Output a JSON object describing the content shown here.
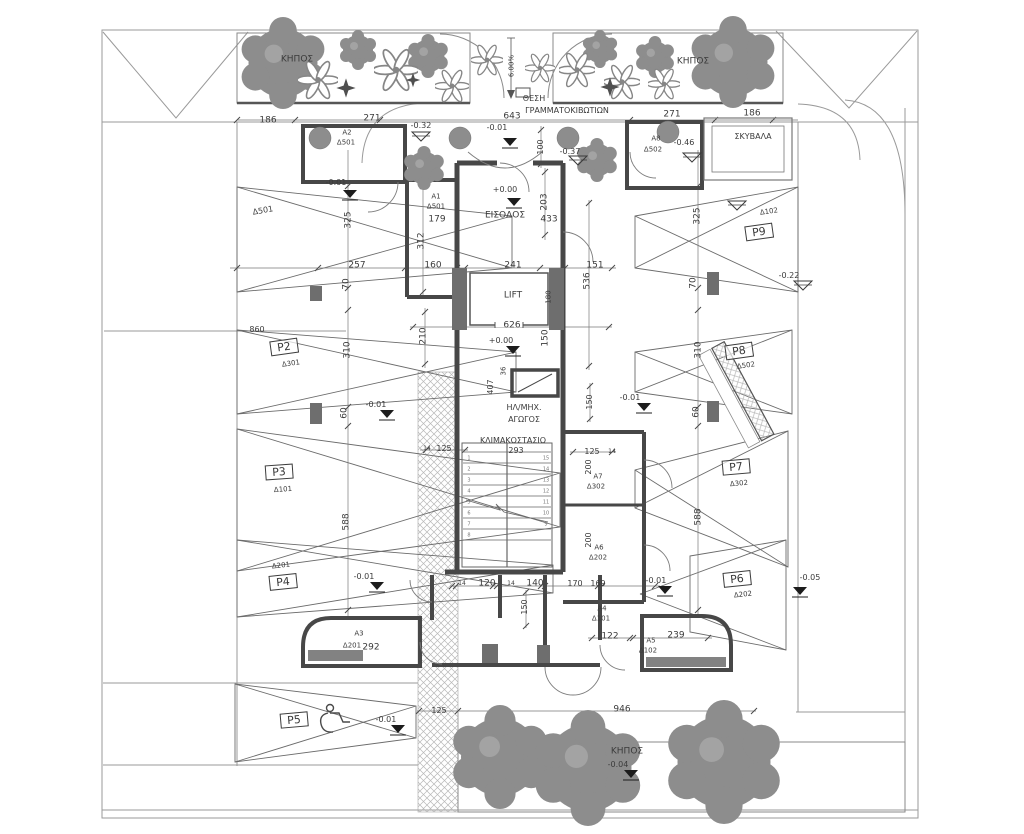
{
  "plan": {
    "building_core": {
      "entrance": "ΕΙΣΟΔΟΣ",
      "entrance_level": "+0.00",
      "lift": "LIFT",
      "staircase": "ΚΛΙΜΑΚΟΣΤΑΣΙΟ",
      "duct": "ΗΛ/ΜΗΧ. ΑΓΩΓΟΣ"
    },
    "storerooms": [
      {
        "id": "Α1",
        "unit": "Δ501"
      },
      {
        "id": "Α2",
        "unit": "Δ501"
      },
      {
        "id": "Α3",
        "unit": "Δ201",
        "width": "292"
      },
      {
        "id": "Α4",
        "unit": "Δ101"
      },
      {
        "id": "Α5",
        "unit": "Δ102",
        "width": "239"
      },
      {
        "id": "Α6",
        "unit": "Δ202",
        "width": "200"
      },
      {
        "id": "Α7",
        "unit": "Δ302",
        "width": "200"
      },
      {
        "id": "Α8",
        "unit": "Δ502"
      }
    ],
    "parking_spaces": [
      {
        "id": "Δ501"
      },
      {
        "id": "P2",
        "unit": "Δ301"
      },
      {
        "id": "P3",
        "unit": "Δ101"
      },
      {
        "id": "P4",
        "unit": "Δ201"
      },
      {
        "id": "P5",
        "accessible": true
      },
      {
        "id": "P6",
        "unit": "Δ202"
      },
      {
        "id": "P7",
        "unit": "Δ302"
      },
      {
        "id": "P8",
        "unit": "Δ502"
      },
      {
        "id": "P9",
        "unit": "Δ102"
      }
    ],
    "gardens": [
      "ΚΗΠΟΣ",
      "ΚΗΠΟΣ",
      "ΚΗΠΟΣ"
    ],
    "refuse_room": "ΣΚΥΒΑΛΑ",
    "mailboxes": "ΘΕΣΗ ΓΡΑΜΜΑΤΟΚΙΒΩΤΙΩΝ",
    "ramp_slope": "6.00%",
    "levels_shown": [
      "+0.00",
      "-0.01",
      "-0.04",
      "-0.05",
      "-0.22",
      "-0.32",
      "-0.37",
      "-0.46"
    ]
  },
  "colors": {
    "paper": "#ffffff",
    "line": "#4a4a4a",
    "wall": "#474747",
    "foliage": "#8d8d8d",
    "hatch": "#b8b8b8"
  },
  "labels": [
    {
      "n": "garden-top-left-label",
      "t": "ΚΗΠΟΣ",
      "x": 297,
      "y": 60,
      "s": 9
    },
    {
      "n": "garden-top-right-label",
      "t": "ΚΗΠΟΣ",
      "x": 693,
      "y": 62,
      "s": 9
    },
    {
      "n": "slope-label",
      "t": "6.00%",
      "x": 512,
      "y": 66,
      "r": -90,
      "s": 7
    },
    {
      "n": "mailbox-label-1",
      "t": "ΘΕΣΗ",
      "x": 534,
      "y": 99,
      "s": 8
    },
    {
      "n": "mailbox-label-2",
      "t": "ΓΡΑΜΜΑΤΟΚΙΒΩΤΙΩΝ",
      "x": 567,
      "y": 111,
      "s": 8
    },
    {
      "n": "dim-643",
      "t": "643",
      "x": 512,
      "y": 117,
      "s": 9
    },
    {
      "n": "dim-186-left",
      "t": "186",
      "x": 268,
      "y": 121,
      "s": 9
    },
    {
      "n": "dim-271-left",
      "t": "271",
      "x": 372,
      "y": 119,
      "s": 9
    },
    {
      "n": "dim-271-right",
      "t": "271",
      "x": 672,
      "y": 115,
      "s": 9
    },
    {
      "n": "dim-186-right",
      "t": "186",
      "x": 752,
      "y": 114,
      "s": 9
    },
    {
      "n": "refuse-room-label",
      "t": "ΣΚΥΒΑΛΑ",
      "x": 753,
      "y": 137,
      "s": 8
    },
    {
      "n": "storeroom-a2-label",
      "t": "Α2",
      "x": 347,
      "y": 133,
      "s": 7
    },
    {
      "n": "storeroom-a2-unit",
      "t": "Δ501",
      "x": 346,
      "y": 143,
      "s": 7
    },
    {
      "n": "level-032",
      "t": "-0.32",
      "x": 421,
      "y": 126,
      "s": 8
    },
    {
      "n": "level-046",
      "t": "-0.46",
      "x": 684,
      "y": 143,
      "s": 8
    },
    {
      "n": "storeroom-a8-label",
      "t": "Α8",
      "x": 656,
      "y": 139,
      "s": 7
    },
    {
      "n": "storeroom-a8-unit",
      "t": "Δ502",
      "x": 653,
      "y": 150,
      "s": 7
    },
    {
      "n": "level-001-topleft",
      "t": "-0.01",
      "x": 336,
      "y": 183,
      "s": 8
    },
    {
      "n": "level-001-topcenter",
      "t": "-0.01",
      "x": 497,
      "y": 128,
      "s": 8
    },
    {
      "n": "dim-100",
      "t": "100",
      "x": 541,
      "y": 147,
      "r": -90,
      "s": 8
    },
    {
      "n": "level-037",
      "t": "-0.37",
      "x": 570,
      "y": 152,
      "s": 8
    },
    {
      "n": "level-000-entrance",
      "t": "+0.00",
      "x": 505,
      "y": 190,
      "s": 8
    },
    {
      "n": "entrance-label",
      "t": "ΕΙΣΟΔΟΣ",
      "x": 505,
      "y": 216,
      "s": 9
    },
    {
      "n": "storeroom-a1-label",
      "t": "Α1",
      "x": 436,
      "y": 197,
      "s": 7
    },
    {
      "n": "storeroom-a1-unit",
      "t": "Δ501",
      "x": 436,
      "y": 207,
      "s": 7
    },
    {
      "n": "dim-179",
      "t": "179",
      "x": 437,
      "y": 220,
      "s": 9
    },
    {
      "n": "dim-312",
      "t": "312",
      "x": 422,
      "y": 241,
      "r": -90,
      "s": 9
    },
    {
      "n": "dim-160",
      "t": "160",
      "x": 433,
      "y": 266,
      "s": 9
    },
    {
      "n": "dim-203",
      "t": "203",
      "x": 545,
      "y": 202,
      "r": -90,
      "s": 9
    },
    {
      "n": "dim-433",
      "t": "433",
      "x": 549,
      "y": 220,
      "s": 9
    },
    {
      "n": "dim-241",
      "t": "241",
      "x": 513,
      "y": 266,
      "s": 9
    },
    {
      "n": "lift-label",
      "t": "LIFT",
      "x": 513,
      "y": 296,
      "s": 9
    },
    {
      "n": "dim-180",
      "t": "180",
      "x": 549,
      "y": 297,
      "r": -90,
      "s": 7
    },
    {
      "n": "dim-151",
      "t": "151",
      "x": 595,
      "y": 266,
      "s": 9
    },
    {
      "n": "dim-536",
      "t": "536",
      "x": 588,
      "y": 281,
      "r": -90,
      "s": 9
    },
    {
      "n": "dim-626",
      "t": "626",
      "x": 512,
      "y": 326,
      "s": 9
    },
    {
      "n": "level-000-court",
      "t": "+0.00",
      "x": 501,
      "y": 341,
      "s": 8
    },
    {
      "n": "dim-210",
      "t": "210",
      "x": 424,
      "y": 336,
      "r": -90,
      "s": 9
    },
    {
      "n": "dim-150-court",
      "t": "150",
      "x": 546,
      "y": 338,
      "r": -90,
      "s": 9
    },
    {
      "n": "dim-36",
      "t": "36",
      "x": 504,
      "y": 371,
      "r": -90,
      "s": 7
    },
    {
      "n": "dim-407",
      "t": "407",
      "x": 491,
      "y": 387,
      "r": -90,
      "s": 8
    },
    {
      "n": "duct-label-1",
      "t": "ΗΛ/ΜΗΧ.",
      "x": 524,
      "y": 408,
      "s": 8
    },
    {
      "n": "duct-label-2",
      "t": "ΑΓΩΓΟΣ",
      "x": 524,
      "y": 420,
      "s": 8
    },
    {
      "n": "staircase-label",
      "t": "ΚΛΙΜΑΚΟΣΤΑΣΙΟ",
      "x": 513,
      "y": 441,
      "s": 8
    },
    {
      "n": "dim-293",
      "t": "293",
      "x": 516,
      "y": 451,
      "s": 8
    },
    {
      "n": "dim-150-right",
      "t": "150",
      "x": 590,
      "y": 402,
      "r": -90,
      "s": 8
    },
    {
      "n": "level-001-stair-right",
      "t": "-0.01",
      "x": 630,
      "y": 398,
      "s": 8
    },
    {
      "n": "dim-14-a",
      "t": "14",
      "x": 427,
      "y": 449,
      "s": 6
    },
    {
      "n": "dim-125-a",
      "t": "125",
      "x": 444,
      "y": 449,
      "s": 8
    },
    {
      "n": "dim-125-b",
      "t": "125",
      "x": 592,
      "y": 452,
      "s": 8
    },
    {
      "n": "dim-14-b",
      "t": "14",
      "x": 612,
      "y": 452,
      "s": 6
    },
    {
      "n": "dim-200-a7",
      "t": "200",
      "x": 589,
      "y": 467,
      "r": -90,
      "s": 8
    },
    {
      "n": "storeroom-a7-label",
      "t": "Α7",
      "x": 598,
      "y": 477,
      "s": 7
    },
    {
      "n": "storeroom-a7-unit",
      "t": "Δ302",
      "x": 596,
      "y": 487,
      "s": 7
    },
    {
      "n": "dim-200-a6",
      "t": "200",
      "x": 589,
      "y": 540,
      "r": -90,
      "s": 8
    },
    {
      "n": "storeroom-a6-label",
      "t": "Α6",
      "x": 599,
      "y": 548,
      "s": 7
    },
    {
      "n": "storeroom-a6-unit",
      "t": "Δ202",
      "x": 598,
      "y": 558,
      "s": 7
    },
    {
      "n": "dim-14-c",
      "t": "14",
      "x": 462,
      "y": 584,
      "s": 6
    },
    {
      "n": "dim-120",
      "t": "120",
      "x": 487,
      "y": 584,
      "s": 9
    },
    {
      "n": "dim-14-d",
      "t": "14",
      "x": 511,
      "y": 584,
      "s": 6
    },
    {
      "n": "dim-140",
      "t": "140",
      "x": 535,
      "y": 584,
      "s": 9
    },
    {
      "n": "dim-170",
      "t": "170",
      "x": 575,
      "y": 584,
      "s": 8
    },
    {
      "n": "dim-169",
      "t": "169",
      "x": 598,
      "y": 584,
      "s": 8
    },
    {
      "n": "dim-150-lower",
      "t": "150",
      "x": 525,
      "y": 607,
      "r": -90,
      "s": 8
    },
    {
      "n": "storeroom-a4-label",
      "t": "Α4",
      "x": 602,
      "y": 609,
      "s": 7
    },
    {
      "n": "storeroom-a4-unit",
      "t": "Δ101",
      "x": 601,
      "y": 619,
      "s": 7
    },
    {
      "n": "dim-122",
      "t": "122",
      "x": 610,
      "y": 637,
      "s": 9
    },
    {
      "n": "storeroom-a5-label",
      "t": "Α5",
      "x": 651,
      "y": 641,
      "s": 7
    },
    {
      "n": "storeroom-a5-unit",
      "t": "Δ102",
      "x": 648,
      "y": 651,
      "s": 7
    },
    {
      "n": "dim-239",
      "t": "239",
      "x": 676,
      "y": 636,
      "s": 9
    },
    {
      "n": "level-001-bottomright",
      "t": "-0.01",
      "x": 656,
      "y": 581,
      "s": 8
    },
    {
      "n": "storeroom-a3-label",
      "t": "Α3",
      "x": 359,
      "y": 634,
      "s": 7
    },
    {
      "n": "storeroom-a3-unit",
      "t": "Δ201",
      "x": 352,
      "y": 646,
      "s": 7
    },
    {
      "n": "dim-292",
      "t": "292",
      "x": 371,
      "y": 648,
      "s": 9
    },
    {
      "n": "parking-d501-label",
      "t": "Δ501",
      "x": 263,
      "y": 211,
      "r": -10,
      "s": 8
    },
    {
      "n": "dim-325-left",
      "t": "325",
      "x": 349,
      "y": 220,
      "r": -90,
      "s": 9
    },
    {
      "n": "dim-257",
      "t": "257",
      "x": 357,
      "y": 266,
      "s": 9
    },
    {
      "n": "dim-70-left",
      "t": "70",
      "x": 347,
      "y": 284,
      "r": -90,
      "s": 9
    },
    {
      "n": "dim-860",
      "t": "860",
      "x": 257,
      "y": 330,
      "s": 8
    },
    {
      "n": "parking-p2-label",
      "t": "P2",
      "x": 284,
      "y": 347,
      "r": -8,
      "s": 11,
      "b": true
    },
    {
      "n": "parking-p2-unit",
      "t": "Δ301",
      "x": 291,
      "y": 364,
      "r": -8,
      "s": 7
    },
    {
      "n": "dim-310-left",
      "t": "310",
      "x": 348,
      "y": 350,
      "r": -90,
      "s": 9
    },
    {
      "n": "dim-60-left",
      "t": "60",
      "x": 345,
      "y": 413,
      "r": -90,
      "s": 9
    },
    {
      "n": "level-001-left-mid",
      "t": "-0.01",
      "x": 376,
      "y": 405,
      "s": 8
    },
    {
      "n": "parking-p3-label",
      "t": "P3",
      "x": 279,
      "y": 472,
      "r": -4,
      "s": 11,
      "b": true
    },
    {
      "n": "parking-p3-unit",
      "t": "Δ101",
      "x": 283,
      "y": 490,
      "r": -4,
      "s": 7
    },
    {
      "n": "dim-588-left",
      "t": "588",
      "x": 347,
      "y": 522,
      "r": -90,
      "s": 9
    },
    {
      "n": "parking-p4-unit",
      "t": "Δ201",
      "x": 281,
      "y": 566,
      "r": -6,
      "s": 7
    },
    {
      "n": "parking-p4-label",
      "t": "P4",
      "x": 283,
      "y": 582,
      "r": -6,
      "s": 11,
      "b": true
    },
    {
      "n": "level-001-p4",
      "t": "-0.01",
      "x": 364,
      "y": 577,
      "s": 8
    },
    {
      "n": "parking-p5-label",
      "t": "P5",
      "x": 294,
      "y": 720,
      "r": -5,
      "s": 11,
      "b": true
    },
    {
      "n": "level-001-p5",
      "t": "-0.01",
      "x": 386,
      "y": 720,
      "s": 8
    },
    {
      "n": "dim-125-c",
      "t": "125",
      "x": 439,
      "y": 711,
      "s": 8
    },
    {
      "n": "parking-p9-unit",
      "t": "Δ102",
      "x": 769,
      "y": 212,
      "r": -8,
      "s": 7
    },
    {
      "n": "parking-p9-label",
      "t": "P9",
      "x": 759,
      "y": 232,
      "r": -8,
      "s": 11,
      "b": true
    },
    {
      "n": "dim-325-right",
      "t": "325",
      "x": 698,
      "y": 216,
      "r": -90,
      "s": 9
    },
    {
      "n": "level-022",
      "t": "-0.22",
      "x": 789,
      "y": 276,
      "s": 8
    },
    {
      "n": "dim-70-right",
      "t": "70",
      "x": 694,
      "y": 283,
      "r": -90,
      "s": 9
    },
    {
      "n": "parking-p8-label",
      "t": "P8",
      "x": 739,
      "y": 351,
      "r": -8,
      "s": 11,
      "b": true
    },
    {
      "n": "parking-p8-unit",
      "t": "Δ502",
      "x": 746,
      "y": 366,
      "r": -8,
      "s": 7
    },
    {
      "n": "dim-310-right",
      "t": "310",
      "x": 699,
      "y": 350,
      "r": -90,
      "s": 9
    },
    {
      "n": "dim-60-right",
      "t": "60",
      "x": 697,
      "y": 412,
      "r": -90,
      "s": 9
    },
    {
      "n": "parking-p7-label",
      "t": "P7",
      "x": 736,
      "y": 467,
      "r": -5,
      "s": 11,
      "b": true
    },
    {
      "n": "parking-p7-unit",
      "t": "Δ302",
      "x": 739,
      "y": 484,
      "r": -5,
      "s": 7
    },
    {
      "n": "dim-588-right",
      "t": "588",
      "x": 699,
      "y": 517,
      "r": -90,
      "s": 9
    },
    {
      "n": "parking-p6-label",
      "t": "P6",
      "x": 737,
      "y": 579,
      "r": -6,
      "s": 11,
      "b": true
    },
    {
      "n": "parking-p6-unit",
      "t": "Δ202",
      "x": 743,
      "y": 595,
      "r": -6,
      "s": 7
    },
    {
      "n": "level-005",
      "t": "-0.05",
      "x": 810,
      "y": 578,
      "s": 8
    },
    {
      "n": "dim-946",
      "t": "946",
      "x": 622,
      "y": 710,
      "s": 9
    },
    {
      "n": "garden-bottom-label",
      "t": "ΚΗΠΟΣ",
      "x": 627,
      "y": 752,
      "s": 9
    },
    {
      "n": "level-004",
      "t": "-0.04",
      "x": 618,
      "y": 765,
      "s": 8
    },
    {
      "n": "stair-step-1",
      "t": "1",
      "x": 469,
      "y": 459,
      "s": 5,
      "c": "#777"
    },
    {
      "n": "stair-step-2",
      "t": "2",
      "x": 469,
      "y": 470,
      "s": 5,
      "c": "#777"
    },
    {
      "n": "stair-step-3",
      "t": "3",
      "x": 469,
      "y": 481,
      "s": 5,
      "c": "#777"
    },
    {
      "n": "stair-step-4",
      "t": "4",
      "x": 469,
      "y": 492,
      "s": 5,
      "c": "#777"
    },
    {
      "n": "stair-step-5",
      "t": "5",
      "x": 469,
      "y": 503,
      "s": 5,
      "c": "#777"
    },
    {
      "n": "stair-step-6",
      "t": "6",
      "x": 469,
      "y": 514,
      "s": 5,
      "c": "#777"
    },
    {
      "n": "stair-step-7",
      "t": "7",
      "x": 469,
      "y": 525,
      "s": 5,
      "c": "#777"
    },
    {
      "n": "stair-step-8",
      "t": "8",
      "x": 469,
      "y": 536,
      "s": 5,
      "c": "#777"
    },
    {
      "n": "stair-step-15",
      "t": "15",
      "x": 546,
      "y": 459,
      "s": 5,
      "c": "#777"
    },
    {
      "n": "stair-step-14",
      "t": "14",
      "x": 546,
      "y": 470,
      "s": 5,
      "c": "#777"
    },
    {
      "n": "stair-step-13",
      "t": "13",
      "x": 546,
      "y": 481,
      "s": 5,
      "c": "#777"
    },
    {
      "n": "stair-step-12",
      "t": "12",
      "x": 546,
      "y": 492,
      "s": 5,
      "c": "#777"
    },
    {
      "n": "stair-step-11",
      "t": "11",
      "x": 546,
      "y": 503,
      "s": 5,
      "c": "#777"
    },
    {
      "n": "stair-step-10",
      "t": "10",
      "x": 546,
      "y": 514,
      "s": 5,
      "c": "#777"
    },
    {
      "n": "stair-step-9",
      "t": "9",
      "x": 546,
      "y": 525,
      "s": 5,
      "c": "#777"
    }
  ]
}
